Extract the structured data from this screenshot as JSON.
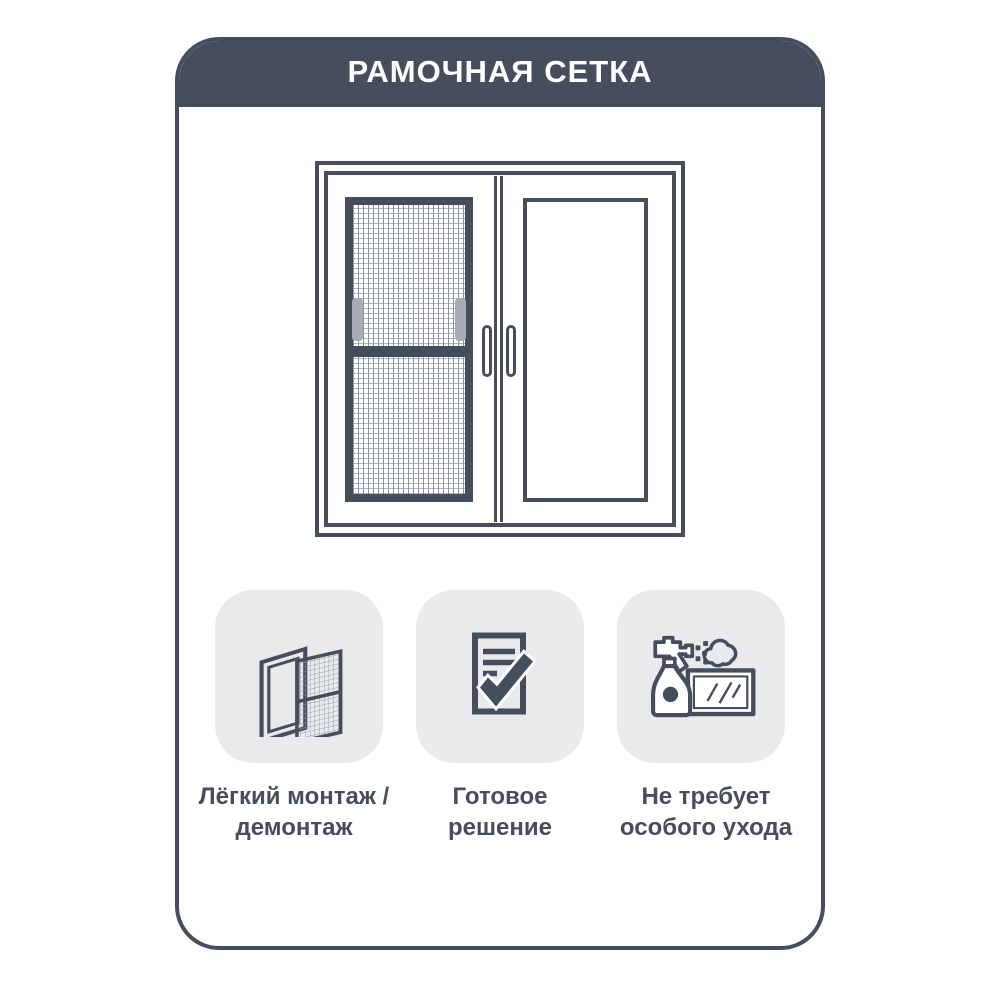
{
  "header": {
    "title": "РАМОЧНАЯ СЕТКА",
    "bg": "#464E5E",
    "text_color": "#FFFFFF"
  },
  "colors": {
    "accent": "#464E5E",
    "card_background": "#FFFFFF",
    "tile_background": "#E8EAEC",
    "mesh_tab_gray": "#A6ABB5",
    "mesh_line_vertical": "#8C93A0",
    "mesh_line_horizontal": "#B0B5BD"
  },
  "illustration": {
    "name": "double-window-with-frame-mosquito-net"
  },
  "features": [
    {
      "icon": "frame-and-mesh-panel-icon",
      "line1": "Лёгкий монтаж /",
      "line2": "демонтаж"
    },
    {
      "icon": "document-checkmark-icon",
      "line1": "Готовое",
      "line2": "решение"
    },
    {
      "icon": "spray-bottle-glass-icon",
      "line1": "Не требует",
      "line2": "особого ухода"
    }
  ]
}
